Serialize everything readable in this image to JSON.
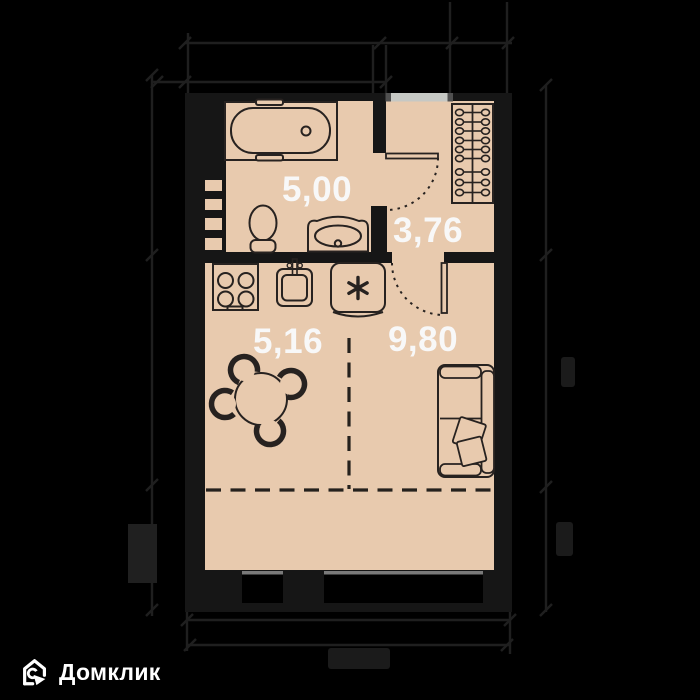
{
  "page": {
    "background_color": "#000000",
    "type_note": "apartment floor plan"
  },
  "plan": {
    "floor_color": "#e8caae",
    "wall_color": "#161616",
    "furniture_outline_color": "#272220",
    "entrance_threshold_color": "#c6c8c4",
    "window_sill_color": "#7a7a7a",
    "rooms": {
      "bathroom": {
        "area": "5,00"
      },
      "hallway": {
        "area": "3,76"
      },
      "kitchen": {
        "area": "5,16"
      },
      "living": {
        "area": "9,80"
      }
    },
    "fixture_icons": [
      "bathtub-icon",
      "toilet-icon",
      "washbasin-icon",
      "ventilation-shaft-icon",
      "stove-icon",
      "kitchen-sink-icon",
      "fridge-icon",
      "wardrobe-hangers-icon",
      "dining-table-icon",
      "chair-icon",
      "sofa-bed-icon",
      "door-swing-arc",
      "window-icon",
      "zone-divider-dashed-line"
    ]
  },
  "dimensions": {
    "line_color": "#1f1f1f",
    "labels_visible": false
  },
  "logo": {
    "text": "Домклик",
    "color": "#ffffff",
    "icon": "domclick-house-icon"
  }
}
